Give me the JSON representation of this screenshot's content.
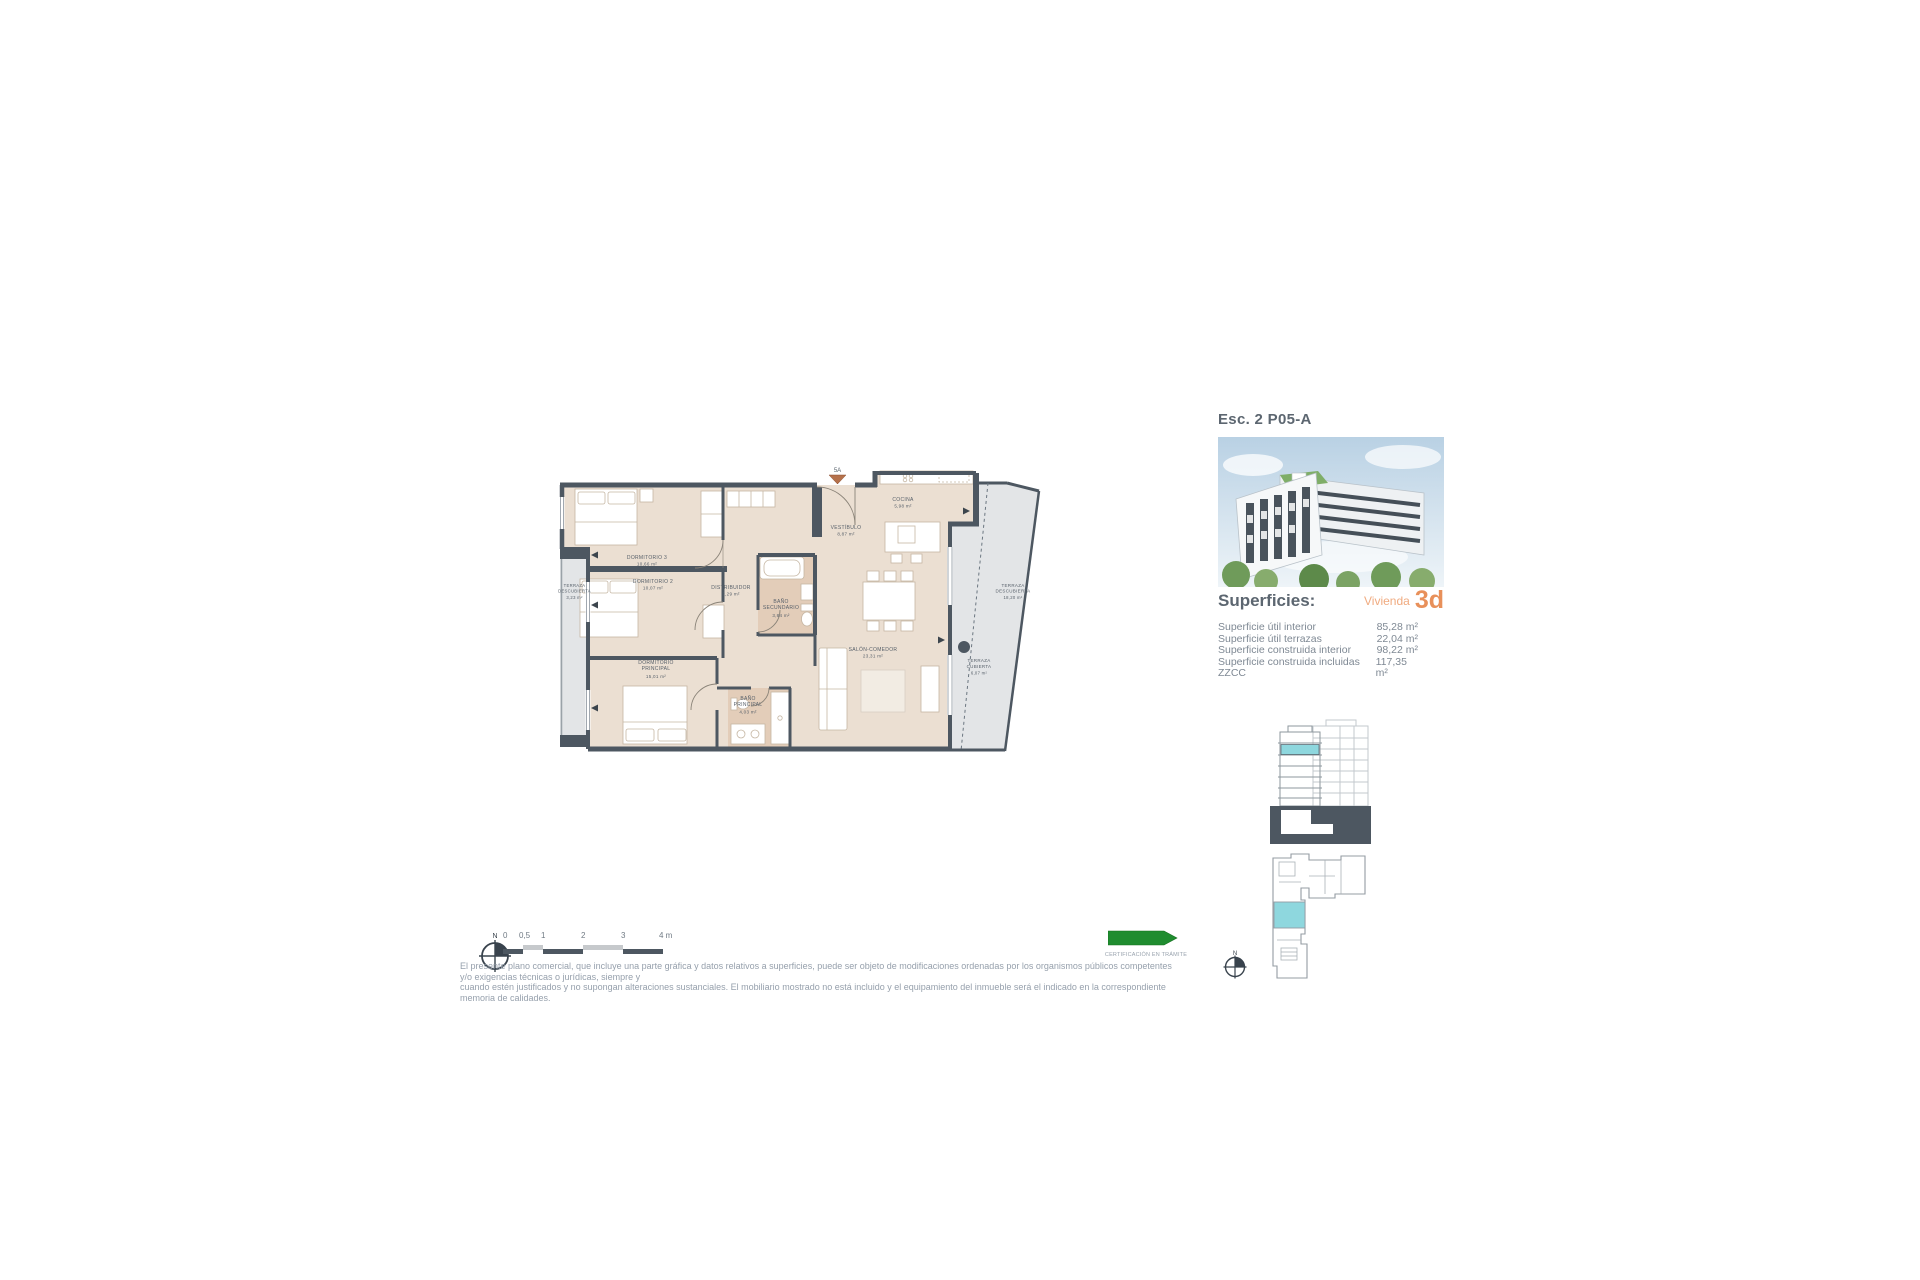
{
  "panel": {
    "title": "Esc. 2 P05-A",
    "superficies_heading": "Superficies:",
    "vivienda_label": "Vivienda",
    "vivienda_value": "3d",
    "rows": [
      {
        "label": "Superficie útil interior",
        "value": "85,28 m²"
      },
      {
        "label": "Superficie útil terrazas",
        "value": "22,04 m²"
      },
      {
        "label": "Superficie construida interior",
        "value": "98,22 m²"
      },
      {
        "label": "Superficie construida incluidas ZZCC",
        "value": "117,35 m²"
      }
    ]
  },
  "plan": {
    "entrance_label": "5A",
    "rooms": {
      "dormitorio3": {
        "line1": "DORMITORIO 3",
        "area": "10,66 m²"
      },
      "dormitorio2": {
        "line1": "DORMITORIO 2",
        "area": "10,07 m²"
      },
      "dormitorio_principal": {
        "line1": "DORMITORIO",
        "line2": "PRINCIPAL",
        "area": "15,01 m²"
      },
      "distribuidor": {
        "line1": "DISTRIBUIDOR",
        "area": "2,29 m²"
      },
      "bano_secundario": {
        "line1": "BAÑO",
        "line2": "SECUNDARIO",
        "area": "3,84 m²"
      },
      "bano_principal": {
        "line1": "BAÑO",
        "line2": "PRINCIPAL",
        "area": "4,03 m²"
      },
      "vestibulo": {
        "line1": "VESTÍBULO",
        "area": "8,87 m²"
      },
      "cocina": {
        "line1": "COCINA",
        "area": "5,98 m²"
      },
      "salon_comedor": {
        "line1": "SALÓN-COMEDOR",
        "area": "23,31 m²"
      },
      "terraza_izquierda": {
        "line1": "TERRAZA",
        "line2": "DESCUBIERTA",
        "area": "3,23 m²"
      },
      "terraza_derecha": {
        "line1": "TERRAZA",
        "line2": "DESCUBIERTA",
        "area": "18,20 m²"
      },
      "terraza_cubierta": {
        "line1": "TERRAZA",
        "line2": "CUBIERTA",
        "area": "6,07 m²"
      }
    }
  },
  "scale_bar": {
    "labels": [
      "0",
      "0,5",
      "1",
      "2",
      "3",
      "4 m"
    ]
  },
  "north_label": "N",
  "certification": {
    "caption": "CERTIFICACIÓN EN TRÁMITE"
  },
  "disclaimer": {
    "line1": "El presente plano comercial, que incluye una parte gráfica y datos relativos a superficies, puede ser objeto de modificaciones ordenadas por los organismos públicos competentes y/o exigencias técnicas o jurídicas, siempre y",
    "line2": "cuando estén justificados y no supongan alteraciones sustanciales. El mobiliario mostrado no está incluido y el equipamiento del inmueble será el indicado en la correspondiente memoria de calidades."
  },
  "colors": {
    "wall": "#4d5761",
    "interior_floor": "#ebdfd2",
    "bath_floor": "#e3cdb9",
    "terrace": "#e3e5e7",
    "accent_orange": "#e8905a",
    "highlight_cyan": "#8ed7de",
    "cert_green": "#1f8c2f"
  }
}
